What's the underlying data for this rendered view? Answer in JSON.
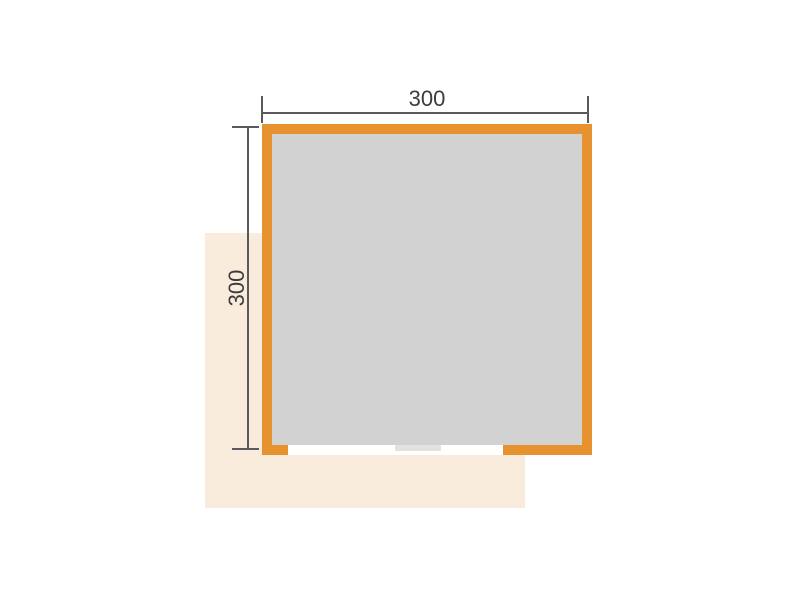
{
  "floor_plan": {
    "width_dimension_label": "300",
    "height_dimension_label": "300",
    "colors": {
      "background": "#FFFFFF",
      "wall": "#E6922E",
      "floor": "#D2D2D3",
      "terrace": "#F9ECDC",
      "opening": "#FFFFFF",
      "threshold": "#E2E2E2",
      "dimension_line": "#5A5A5C",
      "dimension_text": "#3C3C3E"
    }
  }
}
